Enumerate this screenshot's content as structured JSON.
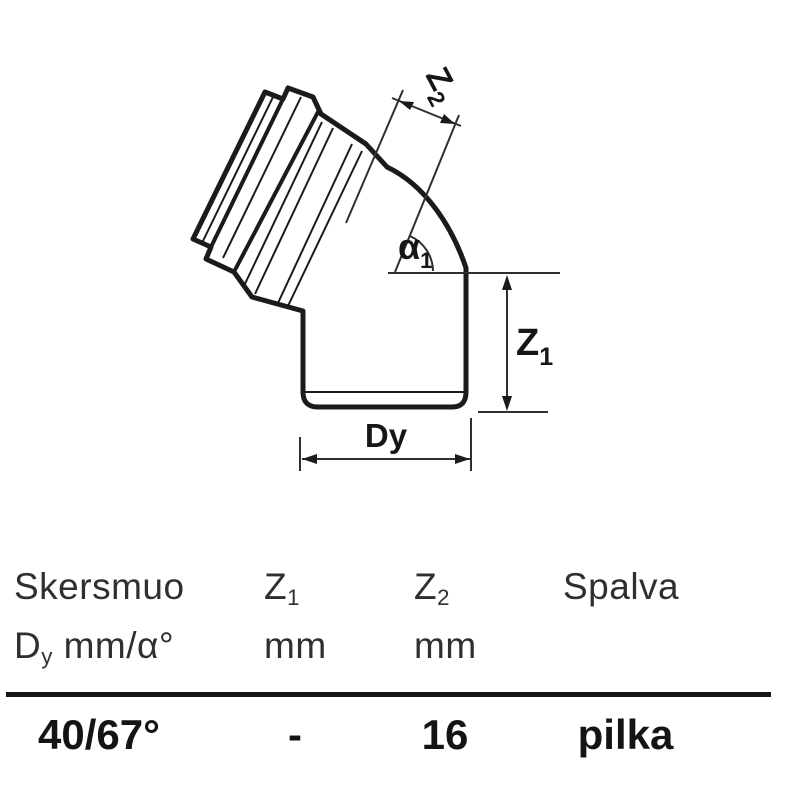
{
  "diagram": {
    "dim_labels": {
      "z2_main": "Z",
      "z2_sub": "2",
      "alpha_main": "α",
      "alpha_sub": "1",
      "z1_main": "Z",
      "z1_sub": "1",
      "dy": "Dy"
    }
  },
  "table": {
    "columns": [
      {
        "header_line1": "Skersmuo",
        "header_line2_main": "D",
        "header_line2_sub": "y",
        "header_line2_rest": " mm/α°"
      },
      {
        "header_line1_main": "Z",
        "header_line1_sub": "1",
        "header_line2": "mm"
      },
      {
        "header_line1_main": "Z",
        "header_line1_sub": "2",
        "header_line2": "mm"
      },
      {
        "header_line1": "Spalva"
      }
    ],
    "row": {
      "diameter_angle": "40/67°",
      "z1": "-",
      "z2": "16",
      "color": "pilka"
    }
  },
  "colors": {
    "background": "#ffffff",
    "outline": "#1b1b1b",
    "dimension_line": "#2f2f2f",
    "header_text": "#2f2f2f",
    "data_text": "#141414",
    "rule": "#161616"
  }
}
